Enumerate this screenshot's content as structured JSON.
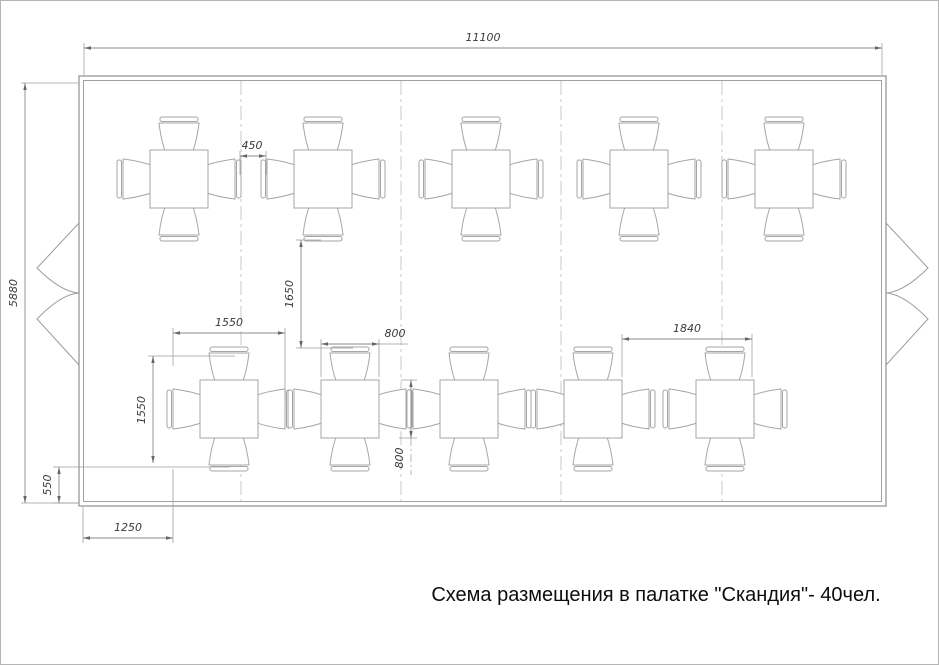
{
  "caption": "Схема размещения в палатке \"Скандия\"- 40чел.",
  "drawing": {
    "tent": {
      "outer": [
        78,
        75,
        807,
        430
      ],
      "inner": [
        82.5,
        79.5,
        798,
        421
      ]
    },
    "seams_x": [
      240,
      400,
      560,
      721
    ],
    "seam_y1": 80,
    "seam_y2": 500,
    "entrances": {
      "left_wall_x": 78,
      "right_wall_x": 885,
      "top_y": 222,
      "mid_y": 292,
      "bottom_y": 364,
      "depth": 42
    },
    "tables": {
      "size": 58,
      "rows": [
        {
          "y": 178,
          "xs": [
            178,
            322,
            480,
            638,
            783
          ]
        },
        {
          "y": 408,
          "xs": [
            228,
            349,
            468,
            592,
            724
          ]
        }
      ]
    },
    "dimensions": [
      {
        "label": "11100",
        "type": "h",
        "y": 47,
        "x1": 83,
        "x2": 881,
        "tx": 482,
        "ty": 40,
        "rot": false,
        "ext": [
          [
            83,
            42,
            83,
            74
          ],
          [
            881,
            42,
            881,
            74
          ]
        ]
      },
      {
        "label": "5880",
        "type": "v",
        "x": 24,
        "y1": 82,
        "y2": 502,
        "tx": 16,
        "ty": 292,
        "rot": true,
        "ext": [
          [
            20,
            82,
            77,
            82
          ],
          [
            20,
            502,
            77,
            502
          ]
        ]
      },
      {
        "label": "450",
        "type": "h",
        "y": 155,
        "x1": 239,
        "x2": 265,
        "tx": 251,
        "ty": 148,
        "rot": false,
        "ext": [
          [
            239,
            150,
            239,
            174
          ],
          [
            265,
            150,
            265,
            174
          ]
        ]
      },
      {
        "label": "1650",
        "type": "v",
        "x": 300,
        "y1": 239,
        "y2": 347,
        "tx": 292,
        "ty": 293,
        "rot": true,
        "ext": [
          [
            295,
            239,
            320,
            239
          ],
          [
            295,
            347,
            352,
            347
          ]
        ]
      },
      {
        "label": "1550",
        "type": "h",
        "y": 332,
        "x1": 172,
        "x2": 284,
        "tx": 228,
        "ty": 325,
        "rot": false,
        "ext": [
          [
            172,
            327,
            172,
            365
          ],
          [
            284,
            327,
            284,
            400
          ]
        ]
      },
      {
        "label": "1550",
        "type": "v",
        "x": 152,
        "y1": 355,
        "y2": 462,
        "tx": 144,
        "ty": 409,
        "rot": true,
        "ext": [
          [
            147,
            355,
            234,
            355
          ]
        ]
      },
      {
        "label": "800",
        "type": "h",
        "y": 343,
        "x1": 320,
        "x2": 378,
        "tx": 394,
        "ty": 336,
        "rot": false,
        "ext": [
          [
            320,
            338,
            320,
            376
          ],
          [
            378,
            338,
            378,
            376
          ]
        ],
        "lead": [
          378,
          343,
          407,
          343
        ]
      },
      {
        "label": "800",
        "type": "v",
        "x": 410,
        "y1": 379,
        "y2": 437,
        "tx": 402,
        "ty": 457,
        "rot": true,
        "ext": [
          [
            400,
            379,
            416,
            379
          ],
          [
            398,
            437,
            416,
            437
          ]
        ],
        "lead": [
          410,
          437,
          410,
          474
        ],
        "lead_dash": true
      },
      {
        "label": "1840",
        "type": "h",
        "y": 338,
        "x1": 621,
        "x2": 751,
        "tx": 686,
        "ty": 331,
        "rot": false,
        "ext": [
          [
            621,
            333,
            621,
            376
          ],
          [
            751,
            333,
            751,
            376
          ]
        ]
      },
      {
        "label": "550",
        "type": "v",
        "x": 58,
        "y1": 466,
        "y2": 502,
        "tx": 50,
        "ty": 484,
        "rot": true,
        "ext": [
          [
            52,
            466,
            229,
            466
          ],
          [
            52,
            502,
            78,
            502
          ]
        ]
      },
      {
        "label": "1250",
        "type": "h",
        "y": 537,
        "x1": 82,
        "x2": 172,
        "tx": 127,
        "ty": 530,
        "rot": false,
        "ext": [
          [
            82,
            506,
            82,
            542
          ],
          [
            172,
            468,
            172,
            542
          ]
        ]
      }
    ]
  }
}
